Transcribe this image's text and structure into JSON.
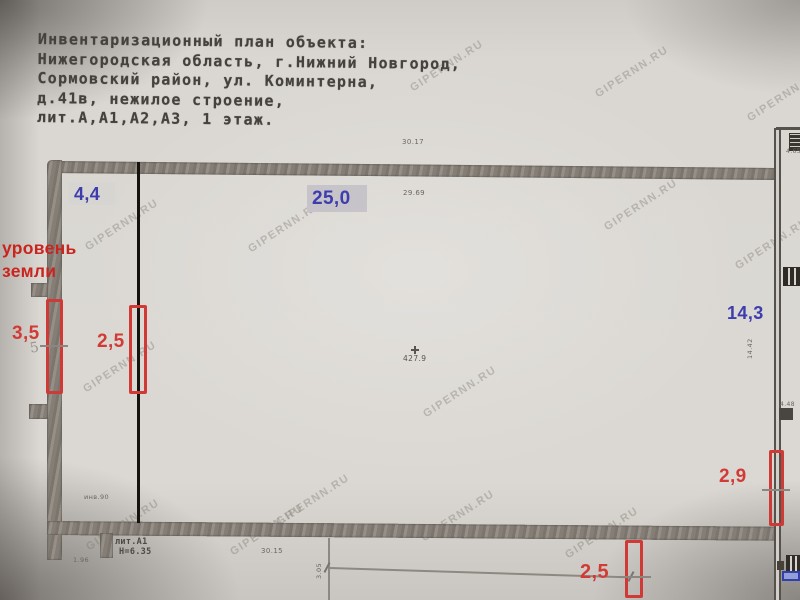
{
  "header": {
    "lines": [
      "Инвентаризационный план объекта:",
      "Нижегородская область, г.Нижний Новгород,",
      "Сормовский район, ул. Коминтерна,",
      "д.41в, нежилое строение,",
      "лит.А,А1,А2,А3, 1 этаж."
    ]
  },
  "watermark": {
    "text": "GIPERNN.RU"
  },
  "measurements": {
    "blue": {
      "top_left_width": "4,4",
      "top_length": "25,0",
      "right_height": "14,3"
    },
    "red": {
      "ground_level_line1": "уровень",
      "ground_level_line2": "земли",
      "left_outer": "3,5",
      "left_inner": "2,5",
      "right_lower": "2,9",
      "bottom_center": "2,5"
    }
  },
  "plan_labels": {
    "top_outer_dim": "30.17",
    "top_inner_dim": "29.69",
    "room_area": "427.9",
    "right_dim": "14.42",
    "bottom_inner_dim": "30.15",
    "bottom_small_dim": "3.05",
    "building_lit": "лит.А1",
    "building_height": "Н=6.35",
    "inv_mark": "инв.90",
    "left_small_dim": "1.96",
    "pencil_mark": "5",
    "right_top_tiny": "4.65",
    "right_mid_tiny": "4.48"
  },
  "colors": {
    "paper": "#d8d5d0",
    "wall": "#86807a",
    "ink": "#45413d",
    "annotation_blue": "#3d3dae",
    "annotation_red": "#d23b35",
    "ground_level_red": "#c9241e",
    "highlight_box": "#c6c4c8",
    "marker_red": "#cf3a36",
    "bar_blue": "#3240ad"
  }
}
